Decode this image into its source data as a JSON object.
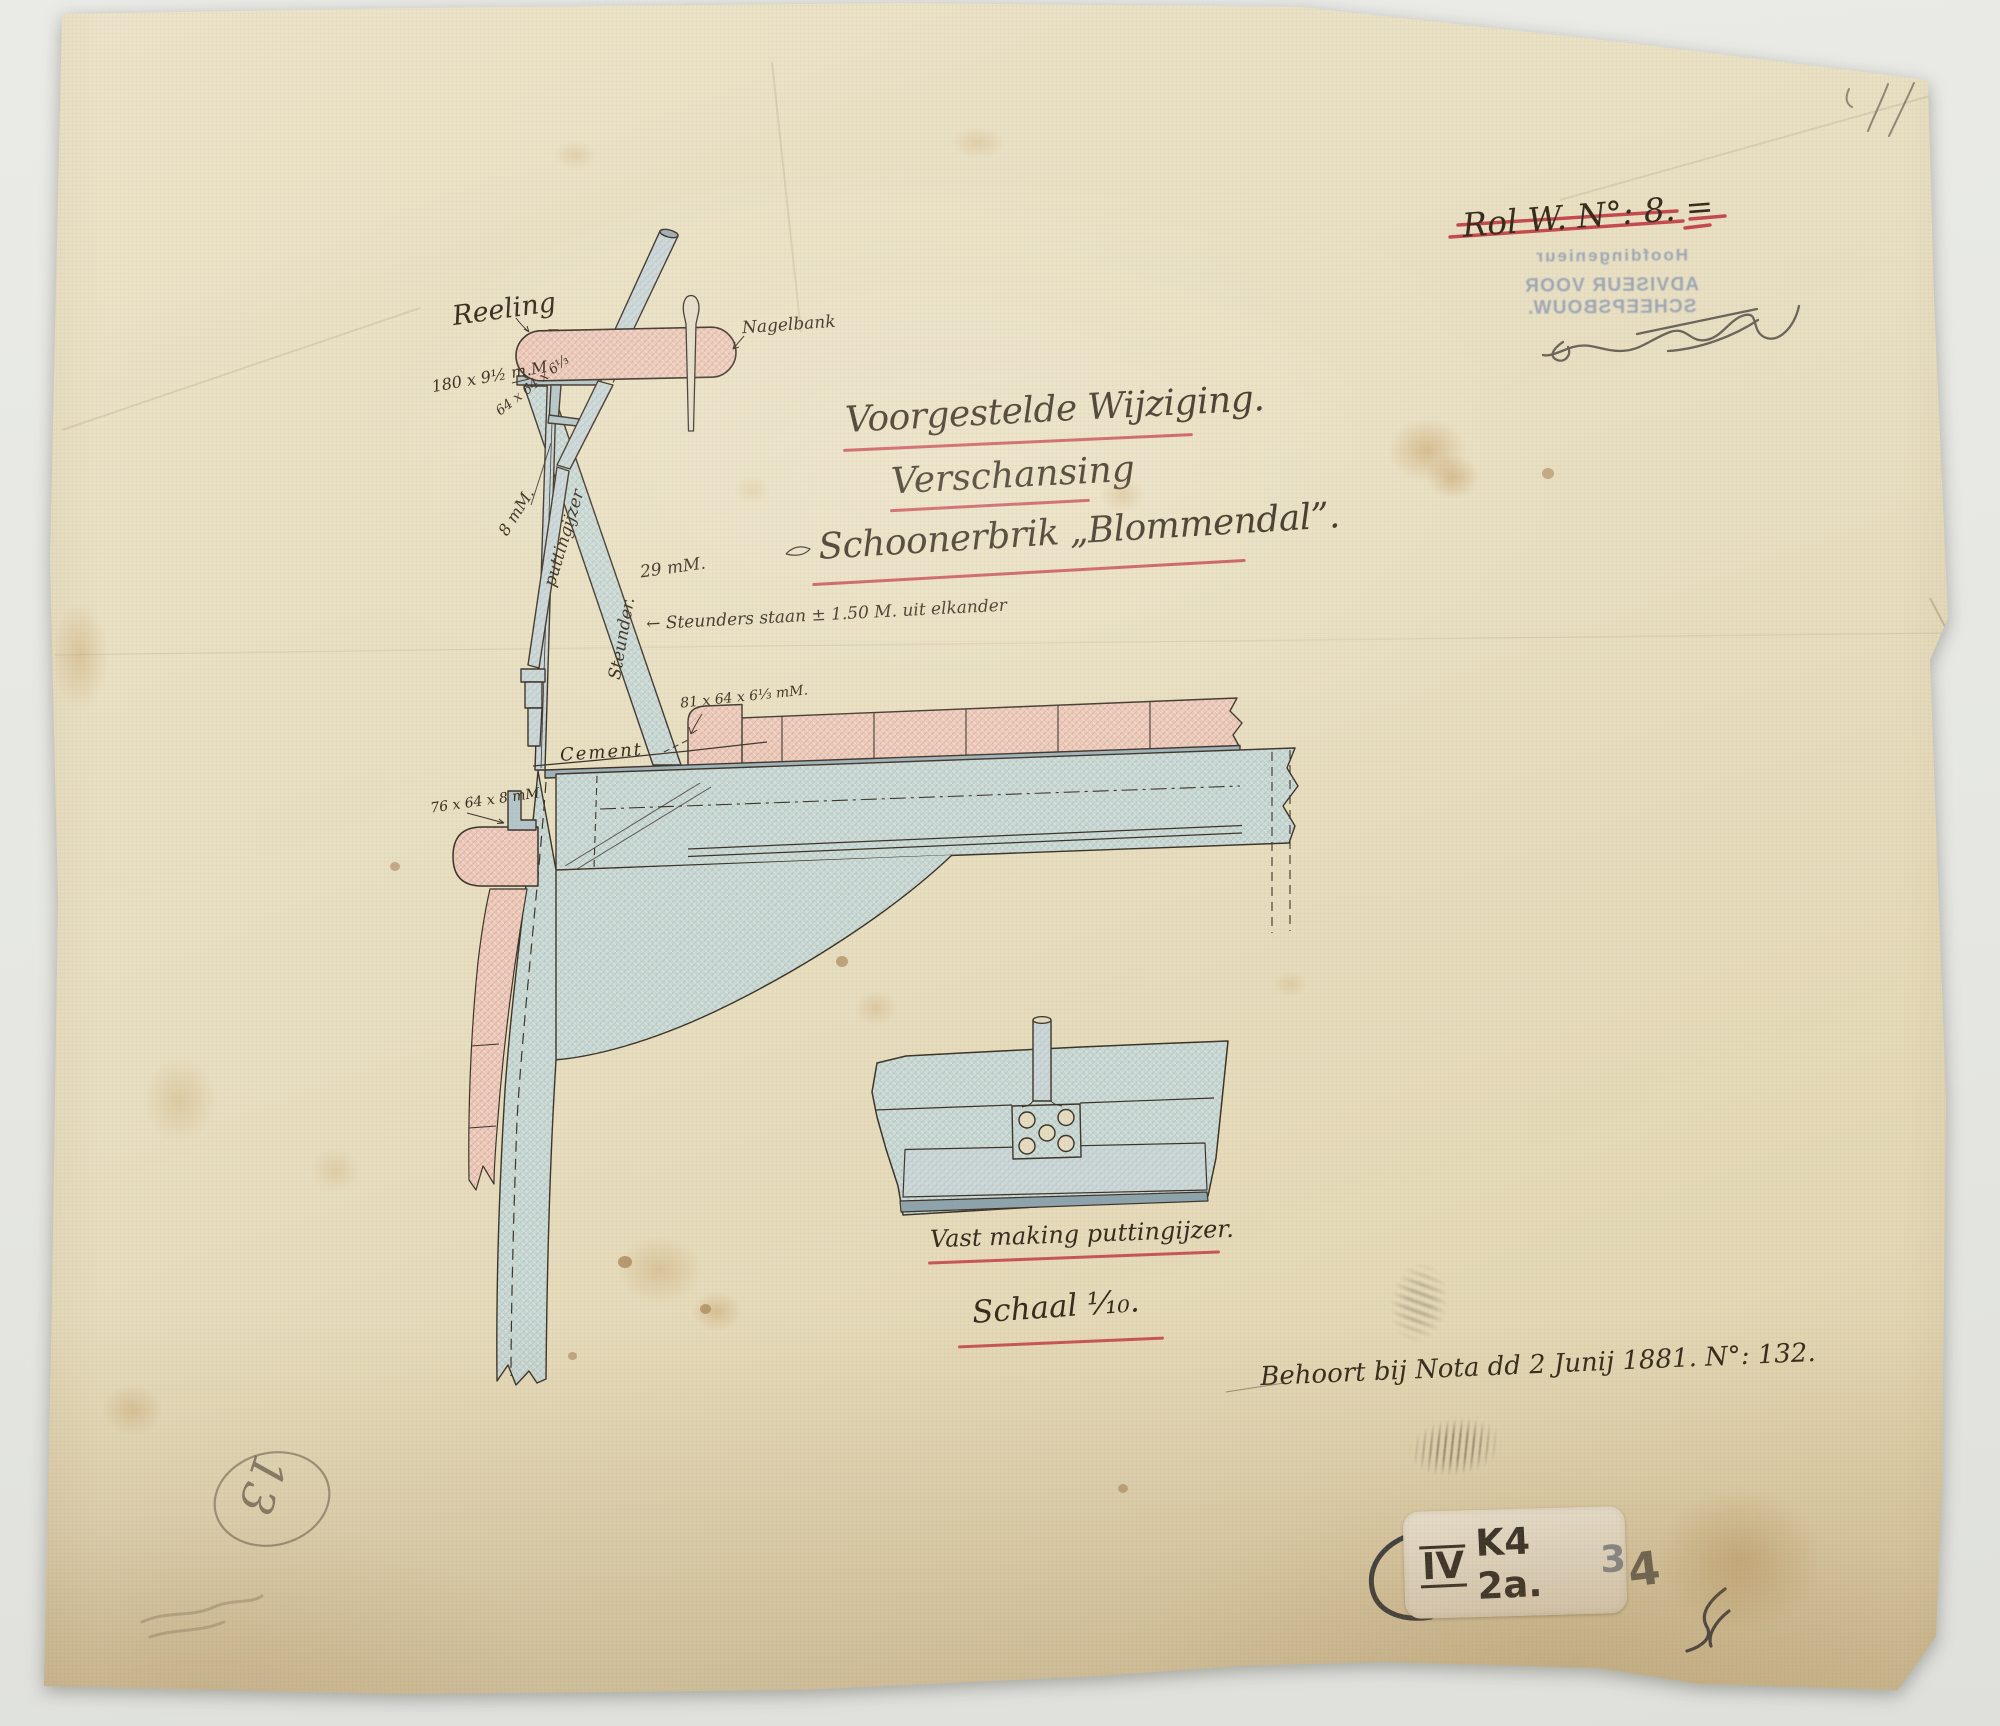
{
  "title": {
    "line1": "Voorgestelde Wijziging.",
    "line2": "Verschansing",
    "line3": "Schoonerbrik „Blommendal”."
  },
  "labels": {
    "reeling": "Reeling",
    "nagelbank": "Nagelbank",
    "rail_plate_size": "180 x 9½ m.M",
    "angle_64": "64 x 64 x 6⅓",
    "plate_8": "8 mM.",
    "puttingijzer": "puttingijzer",
    "steunder": "Steunder.",
    "thickness_29": "29 mM.",
    "steunders_spacing": "← Steunders staan ± 1.50 M. uit elkander",
    "deck_angle": "81 x 64 x 6⅓ mM.",
    "cement": "Cement",
    "outer_angle": "76 x 64 x 8 mM"
  },
  "detail": {
    "caption": "Vast making puttingijzer.",
    "scale": "Schaal ¹⁄₁₀."
  },
  "marks": {
    "rol_label": "Rol W. N°: 8. =",
    "stamp": {
      "line1": "Hoofdingenieur",
      "line2": "ADVISEUR VOOR SCHEEPSBOUW."
    },
    "note": "Behoort bij Nota dd 2 Junij 1881. N°: 132.",
    "pencil_page_number": "13",
    "sticker": {
      "roman": "IV",
      "code": "K4 2a.",
      "digit_faded": "3",
      "digit_outside": "4"
    }
  },
  "colors": {
    "accent_red": "#c4414b",
    "ink": "#362c20",
    "steel_blue": "#c8d8d5",
    "wood_pink": "#ecc9ba",
    "stamp_blue": "#8b9ab4",
    "paper": "#e8dfc2"
  }
}
